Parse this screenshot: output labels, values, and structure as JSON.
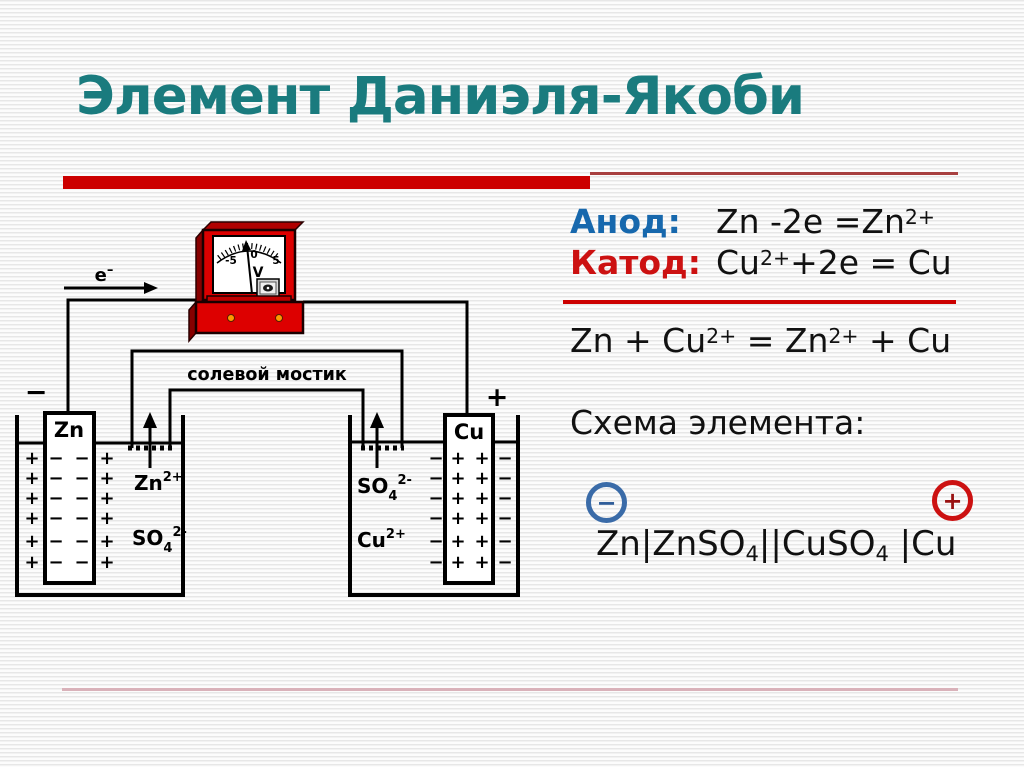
{
  "title": "Элемент Даниэля-Якоби",
  "colors": {
    "title_teal": "#1a7b7e",
    "accent_red": "#cc0000",
    "anode_blue": "#1768ad",
    "cathode_red": "#cc1111",
    "circle_blue": "#3a6ba8",
    "circle_red": "#cc1111",
    "footer_pink": "#d9b2ba",
    "meter_red": "#dd0000"
  },
  "anode": {
    "label": "Анод:",
    "eq_base": "Zn -2e =Zn",
    "eq_sup": "2+"
  },
  "cathode": {
    "label": "Катод:",
    "eq_p1": "Cu",
    "eq_sup1": "2+",
    "eq_p2": "+2e = Cu"
  },
  "overall": {
    "p1": "Zn + Cu",
    "sup1": "2+",
    "p2": " = Zn",
    "sup2": "2+",
    "p3": " + Cu"
  },
  "scheme": {
    "heading": "Схема элемента:",
    "minus_terminal": "−",
    "plus_terminal": "+",
    "p1": "Zn|ZnSO",
    "sub1": "4",
    "p2": "||CuSO",
    "sub2": "4",
    "p3": " |Cu"
  },
  "diagram": {
    "electron": {
      "base": "e",
      "sup": "–"
    },
    "neg_terminal": "−",
    "pos_terminal": "+",
    "salt_bridge_label": "солевой мостик",
    "zn_electrode_label": "Zn",
    "cu_electrode_label": "Cu",
    "zn_ion": {
      "base": "Zn",
      "sup": "2+"
    },
    "so4_ion_left": {
      "base": "SO",
      "sub": "4",
      "sup": "2-"
    },
    "so4_ion_right": {
      "base": "SO",
      "sub": "4",
      "sup": "2-"
    },
    "cu_ion": {
      "base": "Cu",
      "sup": "2+"
    },
    "plus_sign": "+",
    "minus_sign": "−",
    "meter": {
      "scale_left": "-5",
      "scale_mid": "0",
      "scale_right": "5",
      "unit": "V"
    }
  }
}
